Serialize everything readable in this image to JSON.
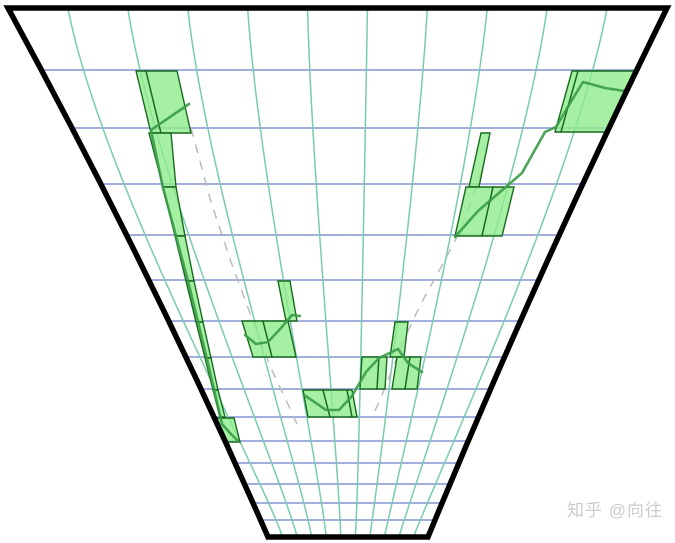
{
  "watermark": {
    "text": "知乎 @向往",
    "color": "#cbcbcb"
  },
  "chart_data": {
    "type": "line",
    "title": "",
    "xlabel": "",
    "ylabel": "",
    "description": "Perspective-warped candlestick-style chart: green grid cells highlight where the price polyline travels on a converging (vanishing-point) grid inside a trapezoid frame.",
    "grid_on": true,
    "canvas": {
      "width": 675,
      "height": 543
    },
    "frame": {
      "top_left": [
        8,
        8
      ],
      "top_right": [
        667,
        8
      ],
      "bottom_left": [
        268,
        537
      ],
      "bottom_right": [
        428,
        537
      ],
      "left_ctrl": [
        152,
        272
      ],
      "right_ctrl": [
        537,
        272
      ],
      "stroke_width": 5.5
    },
    "grid": {
      "vertical_divisions": 11,
      "vanishing_x": 343,
      "top_ctrl_pull": 0.12,
      "top_ctrl_y": 180,
      "bottom_ctrl_push": 0.3,
      "bottom_ctrl_y": 480,
      "row_ys": [
        70,
        128,
        184,
        235,
        280,
        321,
        357,
        389,
        417,
        441,
        463,
        484,
        503,
        520
      ]
    },
    "candles": [
      {
        "ty": 71,
        "tx": [
          136,
          146
        ],
        "by": 133,
        "bx": [
          151,
          161
        ]
      },
      {
        "ty": 71,
        "tx": [
          146,
          177
        ],
        "by": 133,
        "bx": [
          161,
          191
        ]
      },
      {
        "ty": 133,
        "tx": [
          149,
          171
        ],
        "by": 187,
        "bx": [
          163,
          176
        ]
      },
      {
        "ty": 187,
        "tx": [
          163,
          176
        ],
        "by": 236,
        "bx": [
          175,
          185
        ]
      },
      {
        "ty": 236,
        "tx": [
          175,
          185
        ],
        "by": 281,
        "bx": [
          186,
          194
        ]
      },
      {
        "ty": 281,
        "tx": [
          186,
          194
        ],
        "by": 322,
        "bx": [
          196,
          203
        ]
      },
      {
        "ty": 322,
        "tx": [
          196,
          203
        ],
        "by": 358,
        "bx": [
          205,
          211
        ]
      },
      {
        "ty": 358,
        "tx": [
          205,
          211
        ],
        "by": 390,
        "bx": [
          213,
          218
        ]
      },
      {
        "ty": 390,
        "tx": [
          213,
          218
        ],
        "by": 417,
        "bx": [
          220,
          225
        ]
      },
      {
        "ty": 418,
        "tx": [
          214,
          234
        ],
        "by": 442,
        "bx": [
          221,
          240
        ]
      },
      {
        "ty": 281,
        "tx": [
          278,
          290
        ],
        "by": 321,
        "bx": [
          286,
          297
        ]
      },
      {
        "ty": 321,
        "tx": [
          242,
          263
        ],
        "by": 357,
        "bx": [
          253,
          272
        ]
      },
      {
        "ty": 321,
        "tx": [
          263,
          288
        ],
        "by": 357,
        "bx": [
          272,
          296
        ]
      },
      {
        "ty": 390,
        "tx": [
          303,
          323
        ],
        "by": 417,
        "bx": [
          308,
          330
        ]
      },
      {
        "ty": 390,
        "tx": [
          323,
          347
        ],
        "by": 417,
        "bx": [
          330,
          352
        ]
      },
      {
        "ty": 390,
        "tx": [
          347,
          352
        ],
        "by": 417,
        "bx": [
          352,
          357
        ]
      },
      {
        "ty": 357,
        "tx": [
          362,
          379
        ],
        "by": 389,
        "bx": [
          360,
          377
        ]
      },
      {
        "ty": 357,
        "tx": [
          379,
          387
        ],
        "by": 389,
        "bx": [
          377,
          385
        ]
      },
      {
        "ty": 322,
        "tx": [
          395,
          408
        ],
        "by": 357,
        "bx": [
          390,
          404
        ]
      },
      {
        "ty": 357,
        "tx": [
          397,
          410
        ],
        "by": 389,
        "bx": [
          392,
          405
        ]
      },
      {
        "ty": 357,
        "tx": [
          410,
          421
        ],
        "by": 389,
        "bx": [
          405,
          417
        ]
      },
      {
        "ty": 133,
        "tx": [
          481,
          490
        ],
        "by": 187,
        "bx": [
          469,
          479
        ]
      },
      {
        "ty": 187,
        "tx": [
          466,
          493
        ],
        "by": 236,
        "bx": [
          455,
          482
        ]
      },
      {
        "ty": 187,
        "tx": [
          493,
          514
        ],
        "by": 236,
        "bx": [
          482,
          502
        ]
      },
      {
        "ty": 71,
        "tx": [
          572,
          578
        ],
        "by": 132,
        "bx": [
          555,
          561
        ]
      },
      {
        "ty": 71,
        "tx": [
          578,
          634
        ],
        "by": 132,
        "bx": [
          561,
          608
        ]
      }
    ],
    "price_lines": [
      [
        [
          189,
          104
        ],
        [
          151,
          130
        ],
        [
          163,
          188
        ],
        [
          176,
          236
        ],
        [
          188,
          281
        ],
        [
          198,
          322
        ],
        [
          207,
          359
        ],
        [
          215,
          394
        ],
        [
          222,
          424
        ],
        [
          230,
          433
        ],
        [
          238,
          441
        ]
      ],
      [
        [
          245,
          335
        ],
        [
          256,
          344
        ],
        [
          268,
          342
        ],
        [
          281,
          328
        ],
        [
          292,
          315
        ],
        [
          300,
          316
        ]
      ],
      [
        [
          304,
          395
        ],
        [
          313,
          401
        ],
        [
          326,
          410
        ],
        [
          339,
          410
        ],
        [
          352,
          396
        ],
        [
          366,
          372
        ],
        [
          379,
          358
        ],
        [
          398,
          349
        ],
        [
          408,
          363
        ],
        [
          422,
          372
        ]
      ],
      [
        [
          455,
          237
        ],
        [
          478,
          211
        ],
        [
          500,
          192
        ],
        [
          522,
          173
        ],
        [
          545,
          132
        ],
        [
          556,
          127
        ],
        [
          572,
          100
        ],
        [
          583,
          82
        ],
        [
          605,
          88
        ],
        [
          631,
          92
        ]
      ]
    ],
    "dashed_guides": [
      [
        [
          191,
          128
        ],
        [
          211,
          202
        ],
        [
          231,
          262
        ],
        [
          251,
          316
        ],
        [
          270,
          366
        ],
        [
          286,
          400
        ],
        [
          297,
          424
        ]
      ],
      [
        [
          482,
          170
        ],
        [
          470,
          205
        ],
        [
          458,
          235
        ],
        [
          446,
          258
        ],
        [
          434,
          280
        ],
        [
          423,
          300
        ],
        [
          413,
          320
        ],
        [
          402,
          345
        ],
        [
          392,
          370
        ],
        [
          382,
          395
        ],
        [
          374,
          413
        ]
      ]
    ],
    "colors": {
      "background": "#ffffff",
      "frame": "#000000",
      "vertical_grid": "#79cbae",
      "horizontal_grid": "#8494d4",
      "candle_fill": "#8dec8b",
      "candle_fill_opacity": 0.78,
      "candle_stroke": "#176b1d",
      "price_line": "#3a9b47",
      "dashed_guide": "#bbbbbb"
    }
  }
}
